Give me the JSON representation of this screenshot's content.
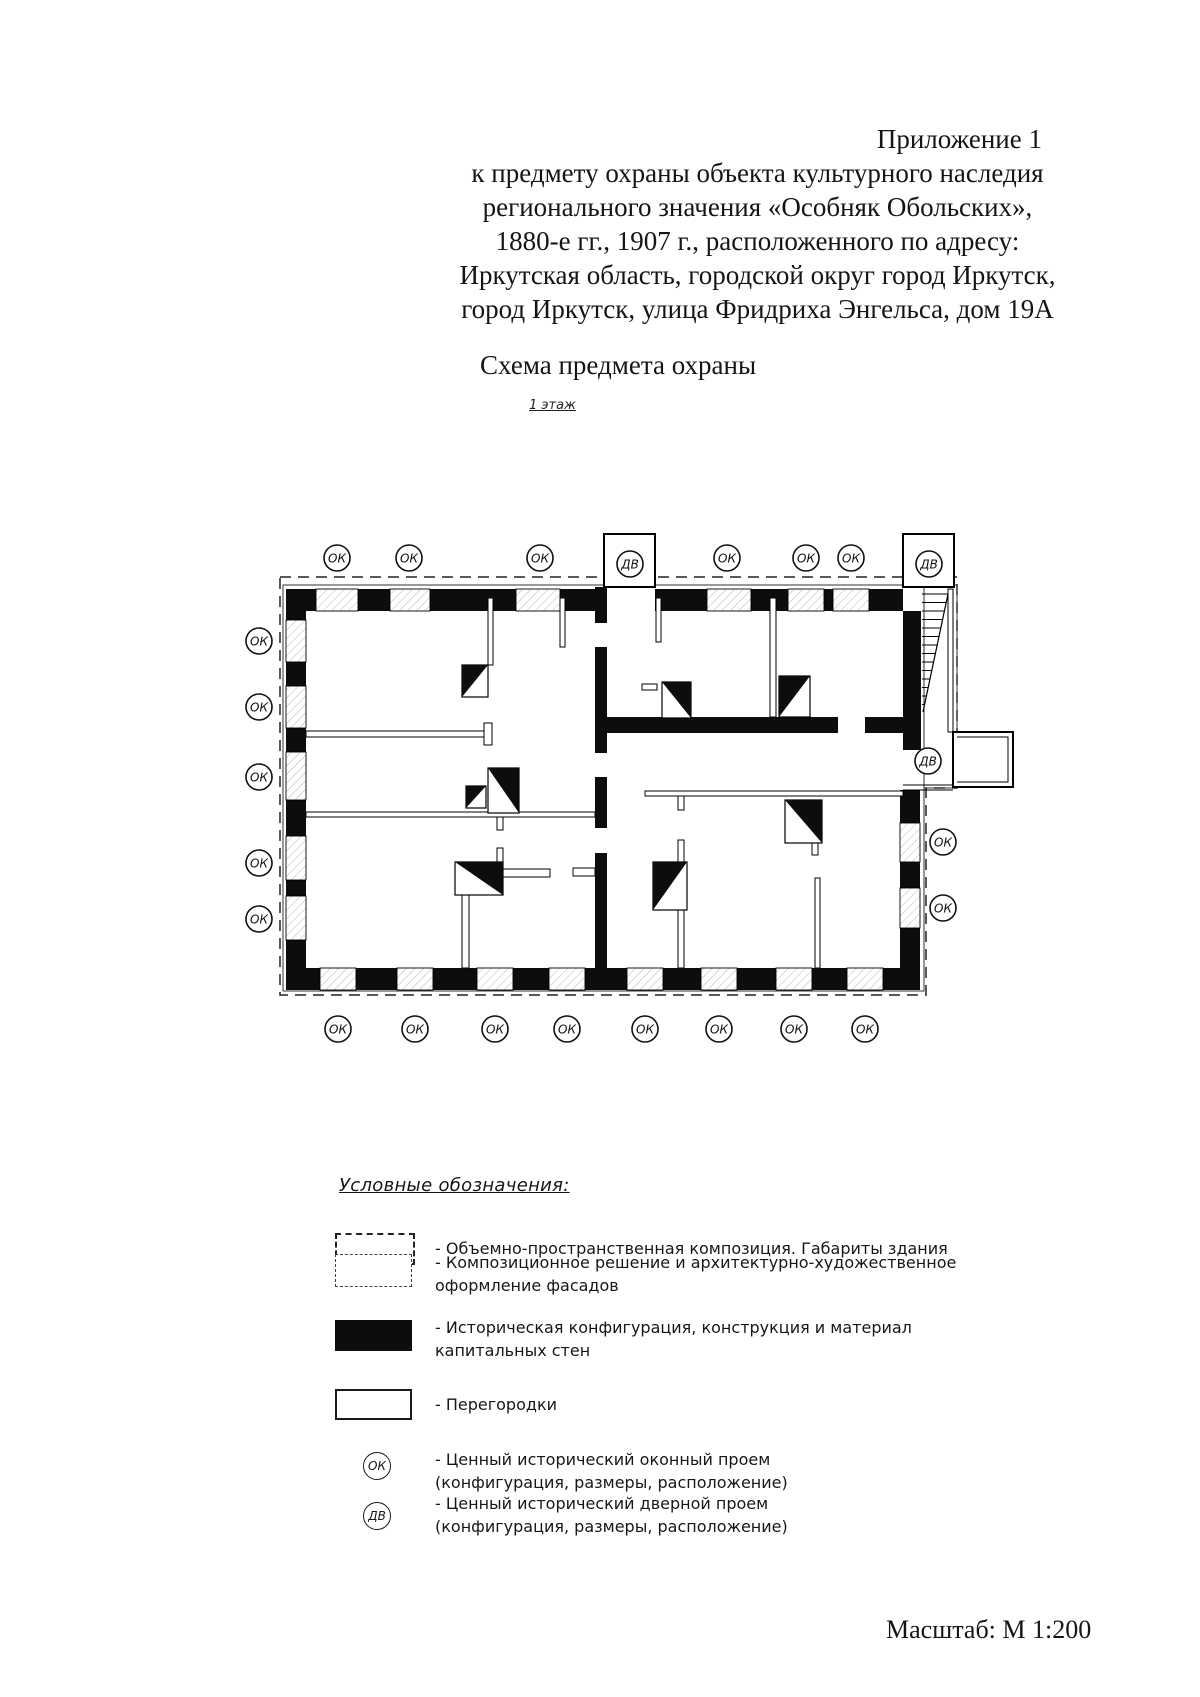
{
  "header": {
    "lines": [
      "Приложение 1",
      "к предмету охраны объекта культурного наследия",
      "регионального значения «Особняк Обольских»,",
      "1880-е гг., 1907 г., расположенного по адресу:",
      "Иркутская область, городской округ город Иркутск,",
      "город Иркутск, улица Фридриха Энгельса, дом 19А"
    ]
  },
  "section_title": "Схема предмета охраны",
  "floor_label": "1 этаж",
  "scale_note": "Масштаб: М 1:200",
  "plan": {
    "window_label": "ОК",
    "door_label": "ДВ",
    "markers": {
      "top": [
        "ОК",
        "ОК",
        "ОК",
        "ДВ",
        "ОК",
        "ОК",
        "ОК",
        "ДВ"
      ],
      "left": [
        "ОК",
        "ОК",
        "ОК",
        "ОК",
        "ОК"
      ],
      "right": [
        "ДВ",
        "ОК",
        "ОК"
      ],
      "bottom": [
        "ОК",
        "ОК",
        "ОК",
        "ОК",
        "ОК",
        "ОК",
        "ОК",
        "ОК"
      ]
    }
  },
  "legend": {
    "title": "Условные обозначения:",
    "items": [
      {
        "symbol": "dashed-rect",
        "lines": [
          "- Объемно-пространственная композиция. Габариты здания",
          ""
        ]
      },
      {
        "symbol": "outline-rect",
        "lines": [
          "- Композиционное решение и архитектурно-художественное",
          "оформление фасадов"
        ]
      },
      {
        "symbol": "filled-rect",
        "lines": [
          "- Историческая конфигурация, конструкция и материал",
          "капитальных стен"
        ]
      },
      {
        "symbol": "partition-rect",
        "lines": [
          "- Перегородки",
          ""
        ]
      },
      {
        "symbol": "window-circle",
        "label": "ОК",
        "lines": [
          "- Ценный исторический оконный проем",
          "(конфигурация, размеры, расположение)"
        ]
      },
      {
        "symbol": "door-circle",
        "label": "ДВ",
        "lines": [
          "- Ценный исторический дверной проем",
          "(конфигурация, размеры, расположение)"
        ]
      }
    ]
  }
}
